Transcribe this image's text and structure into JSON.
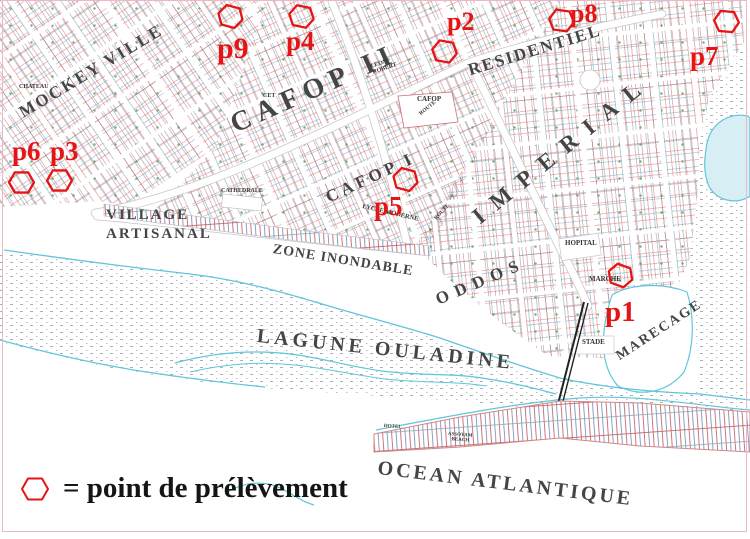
{
  "legend": {
    "symbol_name": "hexagon-outline",
    "text": "= point de prélèvement"
  },
  "colors": {
    "sample_point_red": "#e51515",
    "map_text_gray": "#454545",
    "shoreline_cyan": "#5fc6da",
    "parcel_red": "#c85858",
    "parcel_blue": "#5a8cb0",
    "parcel_green": "#5aa468",
    "border_pink": "#eeb7c2"
  },
  "map": {
    "districts": {
      "mockey_ville": "MOCKEY VILLE",
      "cafop_ii": "CAFOP II",
      "residentiel": "RESIDENTIEL",
      "imperial": "IMPERIAL",
      "cafop_i": "CAFOP I",
      "oddos": "ODDOS"
    },
    "areas": {
      "village_line1": "VILLAGE",
      "village_line2": "ARTISANAL",
      "zone_inondable": "ZONE INONDABLE",
      "lagune": "LAGUNE OULADINE",
      "ocean": "OCEAN ATLANTIQUE",
      "marecage": "MARECAGE"
    },
    "places": {
      "chateau": "CHATEAU",
      "cet": "CET",
      "cathedrale": "CATHEDRALE",
      "leon_line1": "LEON",
      "leon_line2": "ROBERT",
      "cafop": "CAFOP",
      "lycee_moderne": "LYCEE MODERNE",
      "route": "ROUTE",
      "hopital": "HOPITAL",
      "marche": "MARCHE",
      "stade": "STADE",
      "hotel": "HOTEL",
      "beach_line1": "ASSOYAM",
      "beach_line2": "BEACH"
    },
    "sample_points": [
      {
        "id": "p1",
        "label": "p1"
      },
      {
        "id": "p2",
        "label": "p2"
      },
      {
        "id": "p3",
        "label": "p3"
      },
      {
        "id": "p4",
        "label": "p4"
      },
      {
        "id": "p5",
        "label": "p5"
      },
      {
        "id": "p6",
        "label": "p6"
      },
      {
        "id": "p7",
        "label": "p7"
      },
      {
        "id": "p8",
        "label": "p8"
      },
      {
        "id": "p9",
        "label": "p9"
      }
    ]
  }
}
